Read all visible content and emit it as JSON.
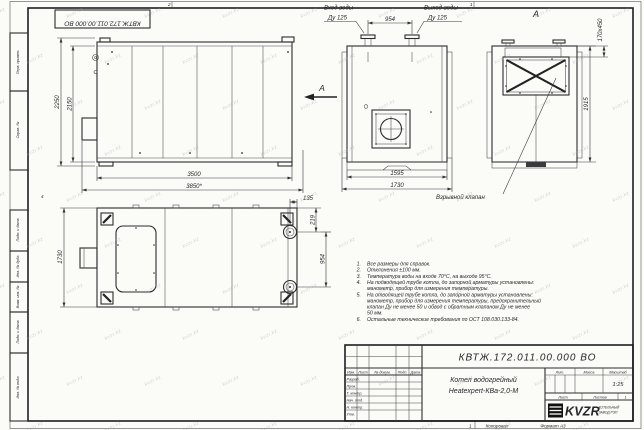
{
  "stamp_top": "КВТЖ.172.011.00.000 ВО",
  "watermark": {
    "text": "kvzr.kz"
  },
  "border": {
    "left_labels": [
      "Перв. примен.",
      "Справ. №",
      "Подп. и дата",
      "Инв. № дубл.",
      "Взам. инв. №",
      "Подп. и дата",
      "Инв. № подл."
    ],
    "zone_top_left": "2",
    "zone_top_right": "1",
    "zone_left": "4",
    "footer_num": "1",
    "footer_copy": "Копировал",
    "footer_format": "Формат А3"
  },
  "views": {
    "side": {
      "dim_height_outer": "2250",
      "dim_height_inner": "2150",
      "dim_length": "3500",
      "dim_length_overall": "3850*",
      "view_arrow_label": "А"
    },
    "front": {
      "inlet_line1": "Вход воды",
      "inlet_line2": "Ду 125",
      "outlet_line1": "Выход воды",
      "outlet_line2": "Ду 125",
      "dim_nozzle_spacing": "954",
      "dim_width": "1595",
      "dim_width_overall": "1730"
    },
    "rear": {
      "view_label": "А",
      "dim_opening": "170х450",
      "dim_height": "1915",
      "callout_explosion_valve": "Взрывной клапан"
    },
    "top": {
      "dim_width": "1730",
      "dim_offset": "135",
      "dim_flange_edge": "219",
      "dim_flange_spacing": "954"
    }
  },
  "notes": [
    {
      "num": "1.",
      "lines": [
        "Все размеры для справок."
      ]
    },
    {
      "num": "2.",
      "lines": [
        "Отклонения ±100 мм."
      ]
    },
    {
      "num": "3.",
      "lines": [
        "Температура воды на входе 70°С, на выходе 95°С."
      ]
    },
    {
      "num": "4.",
      "lines": [
        "На подводящей трубе котла, до запорной арматуры установлены:",
        "манометр, прибор для измерения температуры."
      ]
    },
    {
      "num": "5.",
      "lines": [
        "На отводящей трубе котла, до запорной арматуры установлены:",
        "манометр, прибор для измерения температуры, предохранительный",
        "клапан Ду не менее 50 и обвод с обратным клапаном Ду не менее",
        "50 мм."
      ]
    },
    {
      "num": "6.",
      "lines": [
        "Остальные технические требования по ОСТ 108.030.133-84."
      ]
    }
  ],
  "title_block": {
    "doc_number": "КВТЖ.172.011.00.000 ВО",
    "product_line1": "Котел водогрейный",
    "product_line2": "Heatexpert-КВа-2,0-М",
    "col_headers": {
      "izm": "Изм.",
      "list": "Лист",
      "dokum": "№ докум.",
      "podp": "Подп.",
      "data": "Дата"
    },
    "sign_rows": [
      "Разраб.",
      "Пров.",
      "Т. контр.",
      "Нач. отд.",
      "Н. контр.",
      "Утв."
    ],
    "lit_header": "Лит.",
    "mass_header": "Масса",
    "scale_header": "Масштаб",
    "scale_value": "1:25",
    "sheet_label": "Лист",
    "sheets_label": "Листов",
    "sheets_value": "1",
    "company_abbr": "KVZR",
    "company_line1": "КОТЕЛЬНЫЙ",
    "company_line2": "ЗАВОД РЭП"
  }
}
